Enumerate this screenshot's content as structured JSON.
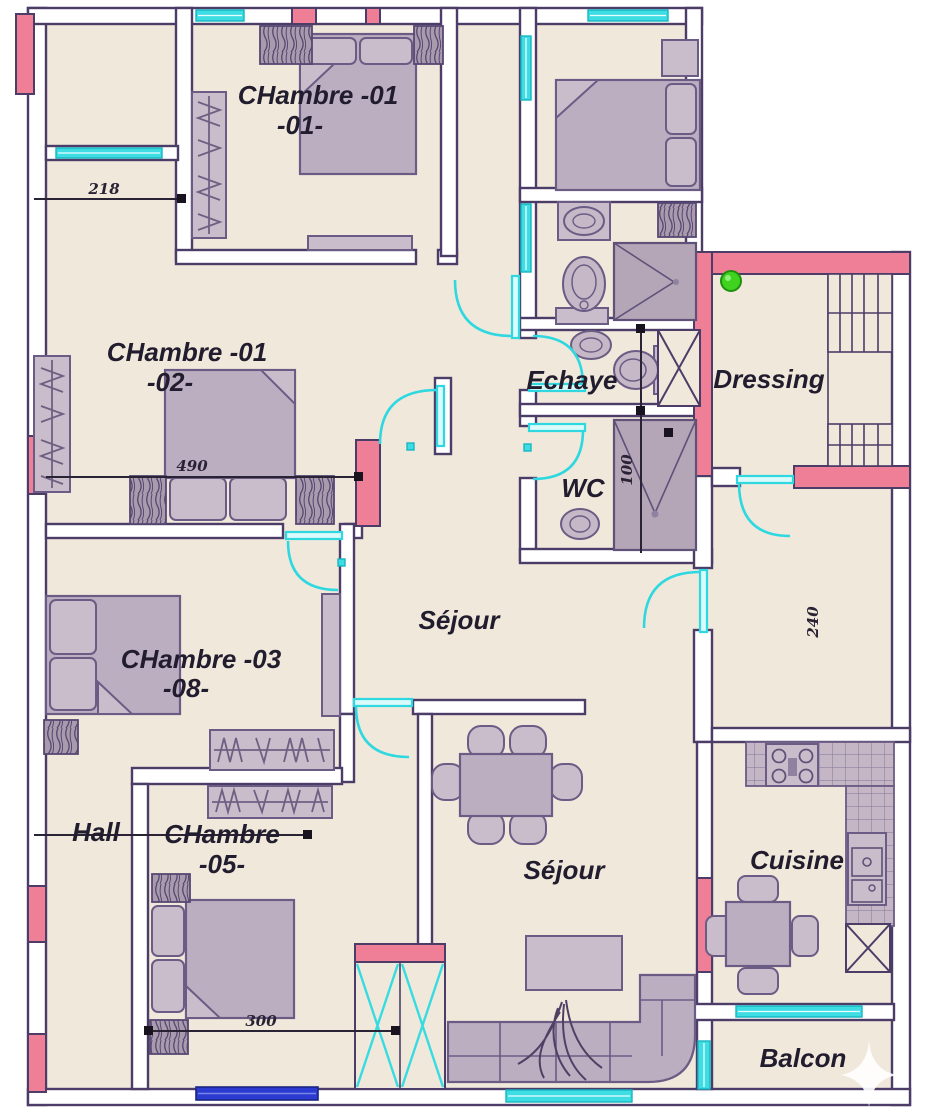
{
  "rooms": {
    "chambre_01_01": {
      "line1": "CHambre -01",
      "line2": "-01-"
    },
    "chambre_01_02": {
      "line1": "CHambre -01",
      "line2": "-02-"
    },
    "chambre_03_08": {
      "line1": "CHambre -03",
      "line2": "-08-"
    },
    "chambre_05": {
      "line1": "CHambre",
      "line2": "-05-"
    },
    "sejour_main": {
      "label": "Séjour"
    },
    "sejour_living": {
      "label": "Séjour"
    },
    "echaye": {
      "label": "Echaye"
    },
    "wc": {
      "label": "WC"
    },
    "dressing": {
      "label": "Dressing"
    },
    "hall": {
      "label": "Hall"
    },
    "cuisine": {
      "label": "Cuisine"
    },
    "balcon": {
      "label": "Balcon"
    }
  },
  "dimensions": {
    "d218": "218",
    "d490": "490",
    "d100": "100",
    "d240": "240",
    "d300": "300"
  },
  "colors": {
    "floor": "#f0e9db",
    "wall_outline": "#4b3d68",
    "accent_pink": "#ee7f97",
    "accent_cyan": "#3edde4",
    "furniture": "#bcaec1",
    "window_blue": "#2b3ad0",
    "green_marker": "#3fd320",
    "text": "#221d2e"
  }
}
